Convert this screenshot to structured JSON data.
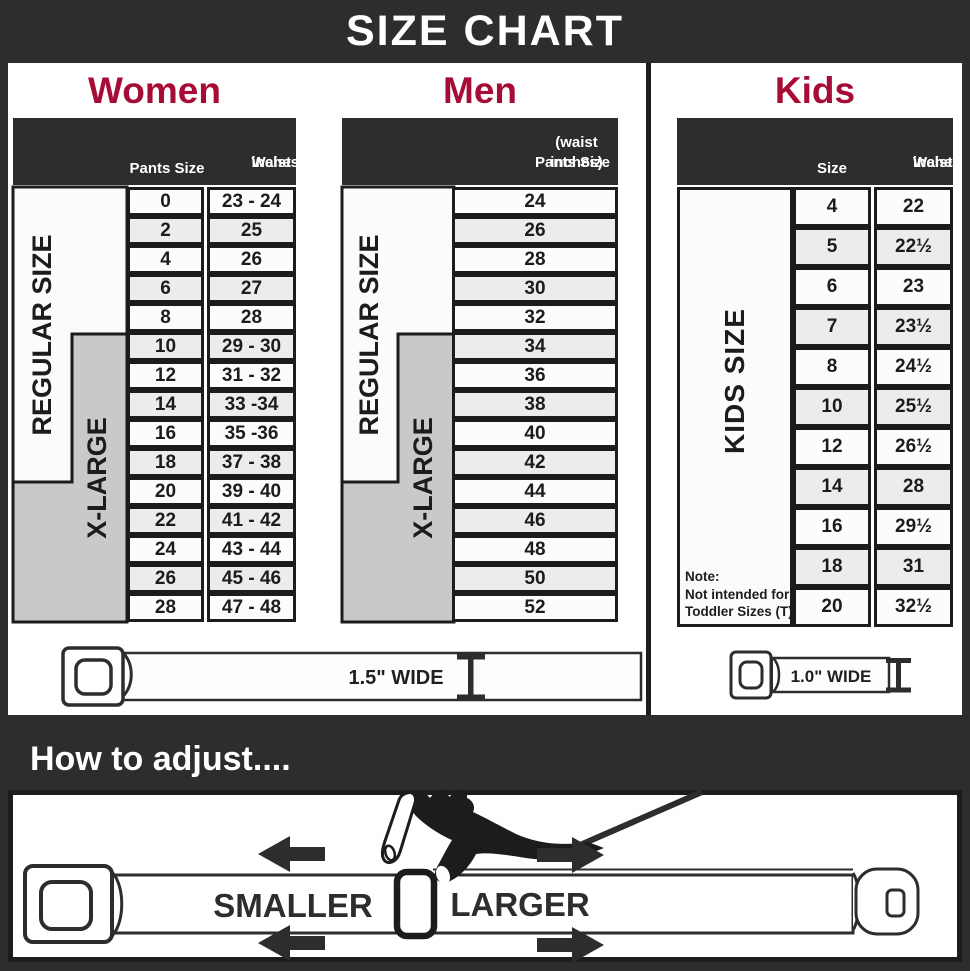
{
  "title": "SIZE CHART",
  "colors": {
    "charcoal": "#2d2d2d",
    "accent_red": "#a60c36",
    "table_border": "#1c1c1c",
    "row_alt_gray": "#ececec",
    "xlarge_gray": "#c9c9c9"
  },
  "women": {
    "heading": "Women",
    "header": {
      "col1": "Pants Size",
      "col2_line1": "Waist",
      "col2_line2": "inches"
    },
    "regular_label": "REGULAR SIZE",
    "xlarge_label": "X-LARGE",
    "rows": [
      [
        "0",
        "23 - 24"
      ],
      [
        "2",
        "25"
      ],
      [
        "4",
        "26"
      ],
      [
        "6",
        "27"
      ],
      [
        "8",
        "28"
      ],
      [
        "10",
        "29 - 30"
      ],
      [
        "12",
        "31 - 32"
      ],
      [
        "14",
        "33 -34"
      ],
      [
        "16",
        "35 -36"
      ],
      [
        "18",
        "37 - 38"
      ],
      [
        "20",
        "39 - 40"
      ],
      [
        "22",
        "41 - 42"
      ],
      [
        "24",
        "43 - 44"
      ],
      [
        "26",
        "45 - 46"
      ],
      [
        "28",
        "47 - 48"
      ]
    ],
    "belt_width_label": "1.5\" WIDE"
  },
  "men": {
    "heading": "Men",
    "header": {
      "line1": "Pants Size",
      "line2": "(waist inches)"
    },
    "regular_label": "REGULAR SIZE",
    "xlarge_label": "X-LARGE",
    "rows": [
      "24",
      "26",
      "28",
      "30",
      "32",
      "34",
      "36",
      "38",
      "40",
      "42",
      "44",
      "46",
      "48",
      "50",
      "52"
    ]
  },
  "kids": {
    "heading": "Kids",
    "header": {
      "col1": "Size",
      "col2_line1": "Waist",
      "col2_line2": "inches"
    },
    "side_label": "KIDS SIZE",
    "note_line1": "Note:",
    "note_line2": "Not intended for",
    "note_line3": "Toddler Sizes (T)",
    "rows": [
      [
        "4",
        "22"
      ],
      [
        "5",
        "22½"
      ],
      [
        "6",
        "23"
      ],
      [
        "7",
        "23½"
      ],
      [
        "8",
        "24½"
      ],
      [
        "10",
        "25½"
      ],
      [
        "12",
        "26½"
      ],
      [
        "14",
        "28"
      ],
      [
        "16",
        "29½"
      ],
      [
        "18",
        "31"
      ],
      [
        "20",
        "32½"
      ]
    ],
    "belt_width_label": "1.0\" WIDE"
  },
  "adjust": {
    "heading": "How to adjust....",
    "smaller_label": "SMALLER",
    "larger_label": "LARGER"
  }
}
